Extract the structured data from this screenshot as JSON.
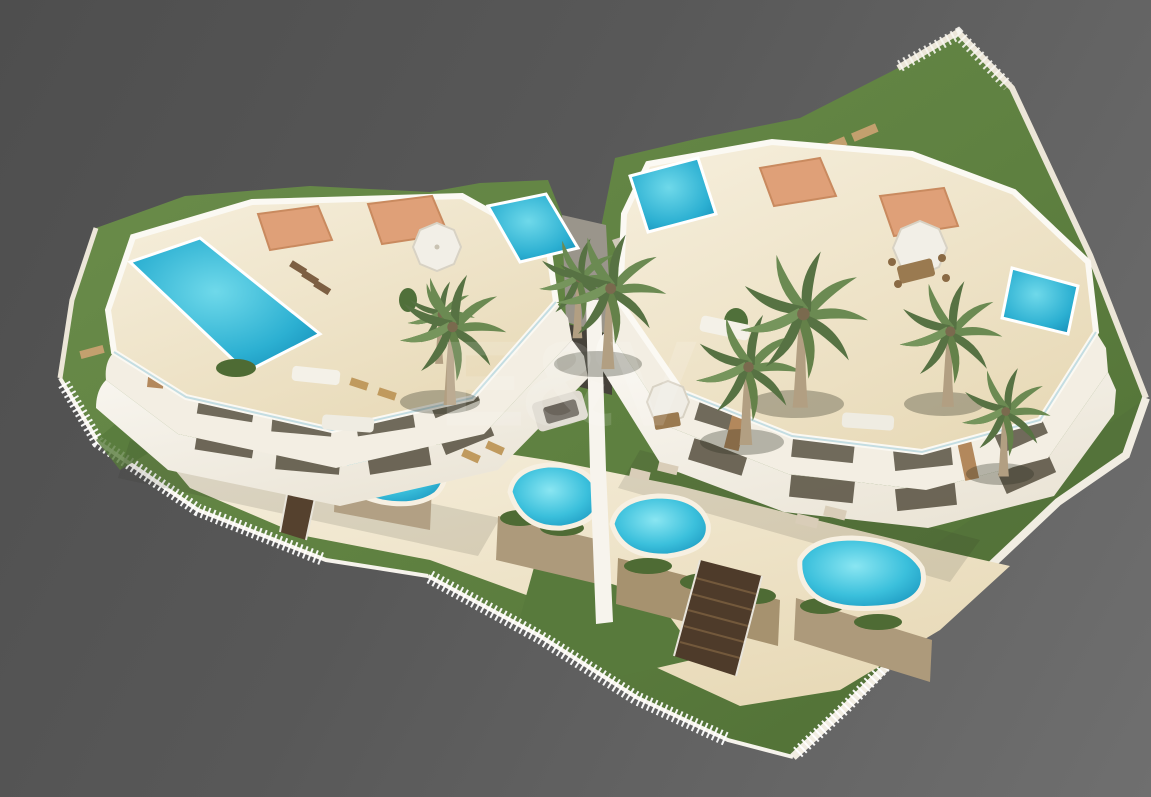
{
  "scene": {
    "type": "architectural-3d-render",
    "description": "Aerial 3D visualization of a modern white two-block residential complex with rooftop terraces, rooftop and garden swimming pools, palm trees, lawns, stepping-stone paths and a white perimeter fence, presented on a plain gray studio background",
    "watermark": "E&V"
  },
  "colors": {
    "background_dark": "#4e4e4e",
    "background_light": "#6f6f6f",
    "lawn": "#5e8040",
    "lawn_dark": "#4c6a32",
    "building_white": "#f7f4ed",
    "facade_shadow": "#e8e2d4",
    "deck_cream": "#eee3cb",
    "pool_bright": "#7fe3ef",
    "pool_deep": "#1b9fc6",
    "shade_sail": "#dfa078",
    "wood_accent": "#b3885c",
    "wall_tan": "#ad9a7b",
    "paving": "#cfc8b8",
    "stone_path": "#c9a271",
    "fence_white": "#f6f3ec",
    "stair_wood": "#4e3b2a",
    "glass": "#b7d6dd",
    "planter_green": "#4e6b34"
  }
}
